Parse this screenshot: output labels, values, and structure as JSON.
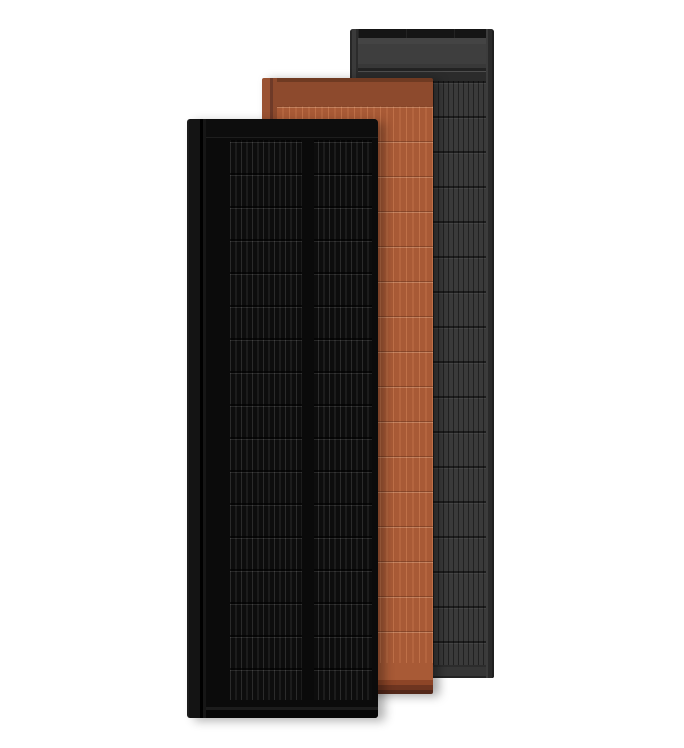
{
  "scene": {
    "name": "solar-roof-panels-product-render",
    "background": "#ffffff",
    "panels": [
      {
        "name": "matte-black-solar-panel",
        "position": "front",
        "colors": {
          "frame": "#0b0b0b",
          "flange": "#141414",
          "cell_background": "#0d0d0d",
          "wire": "#2b2b2b",
          "edge_highlight": "#1e1e1e"
        }
      },
      {
        "name": "terracotta-solar-panel",
        "position": "middle",
        "colors": {
          "header": "#8d4a2d",
          "body": "#a85a36",
          "stripe": "#bf7048",
          "flange": "#9a5232",
          "footer_shadow": "#53281a"
        }
      },
      {
        "name": "slate-gray-solar-panel",
        "position": "back",
        "colors": {
          "top_bar": "#151515",
          "header": "#3e3e3e",
          "frame": "#2f2f2f",
          "cell_background": "#2a2a2a",
          "stripe": "#3a3a3a",
          "footer": "#363636"
        }
      }
    ]
  }
}
